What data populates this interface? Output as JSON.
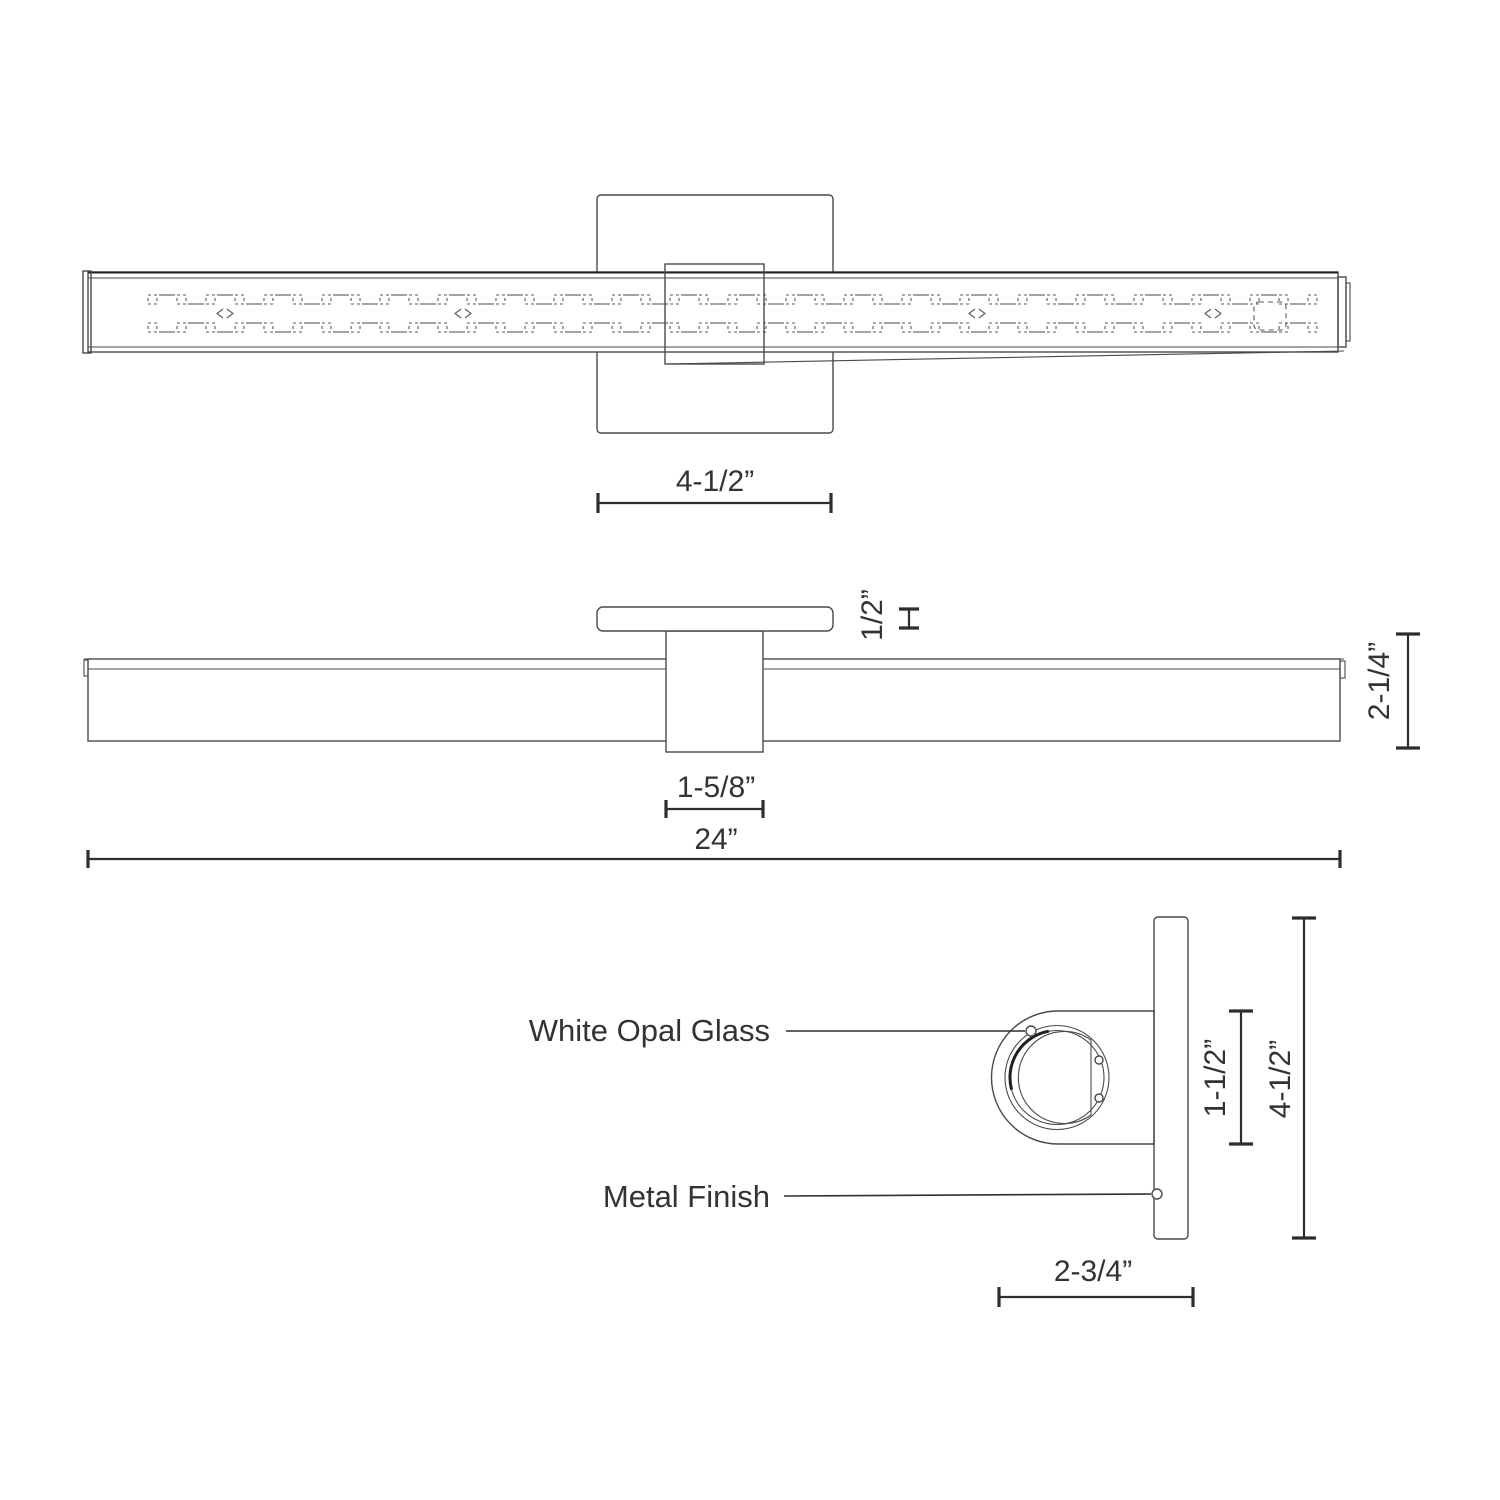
{
  "drawing": {
    "top_view": {
      "dim_canopy_width": "4-1/2”"
    },
    "front_view": {
      "dim_plate_thickness": "1/2”",
      "dim_fixture_height": "2-1/4”",
      "dim_arm_width": "1-5/8”",
      "dim_overall_width": "24”"
    },
    "side_view": {
      "label_glass": "White Opal Glass",
      "label_finish": "Metal Finish",
      "dim_housing_diameter": "1-1/2”",
      "dim_backplate_height": "4-1/2”",
      "dim_depth": "2-3/4”"
    },
    "colors": {
      "line": "#4a4a4a",
      "dimension": "#2e2e2e",
      "text": "#333333",
      "background": "#ffffff"
    }
  }
}
